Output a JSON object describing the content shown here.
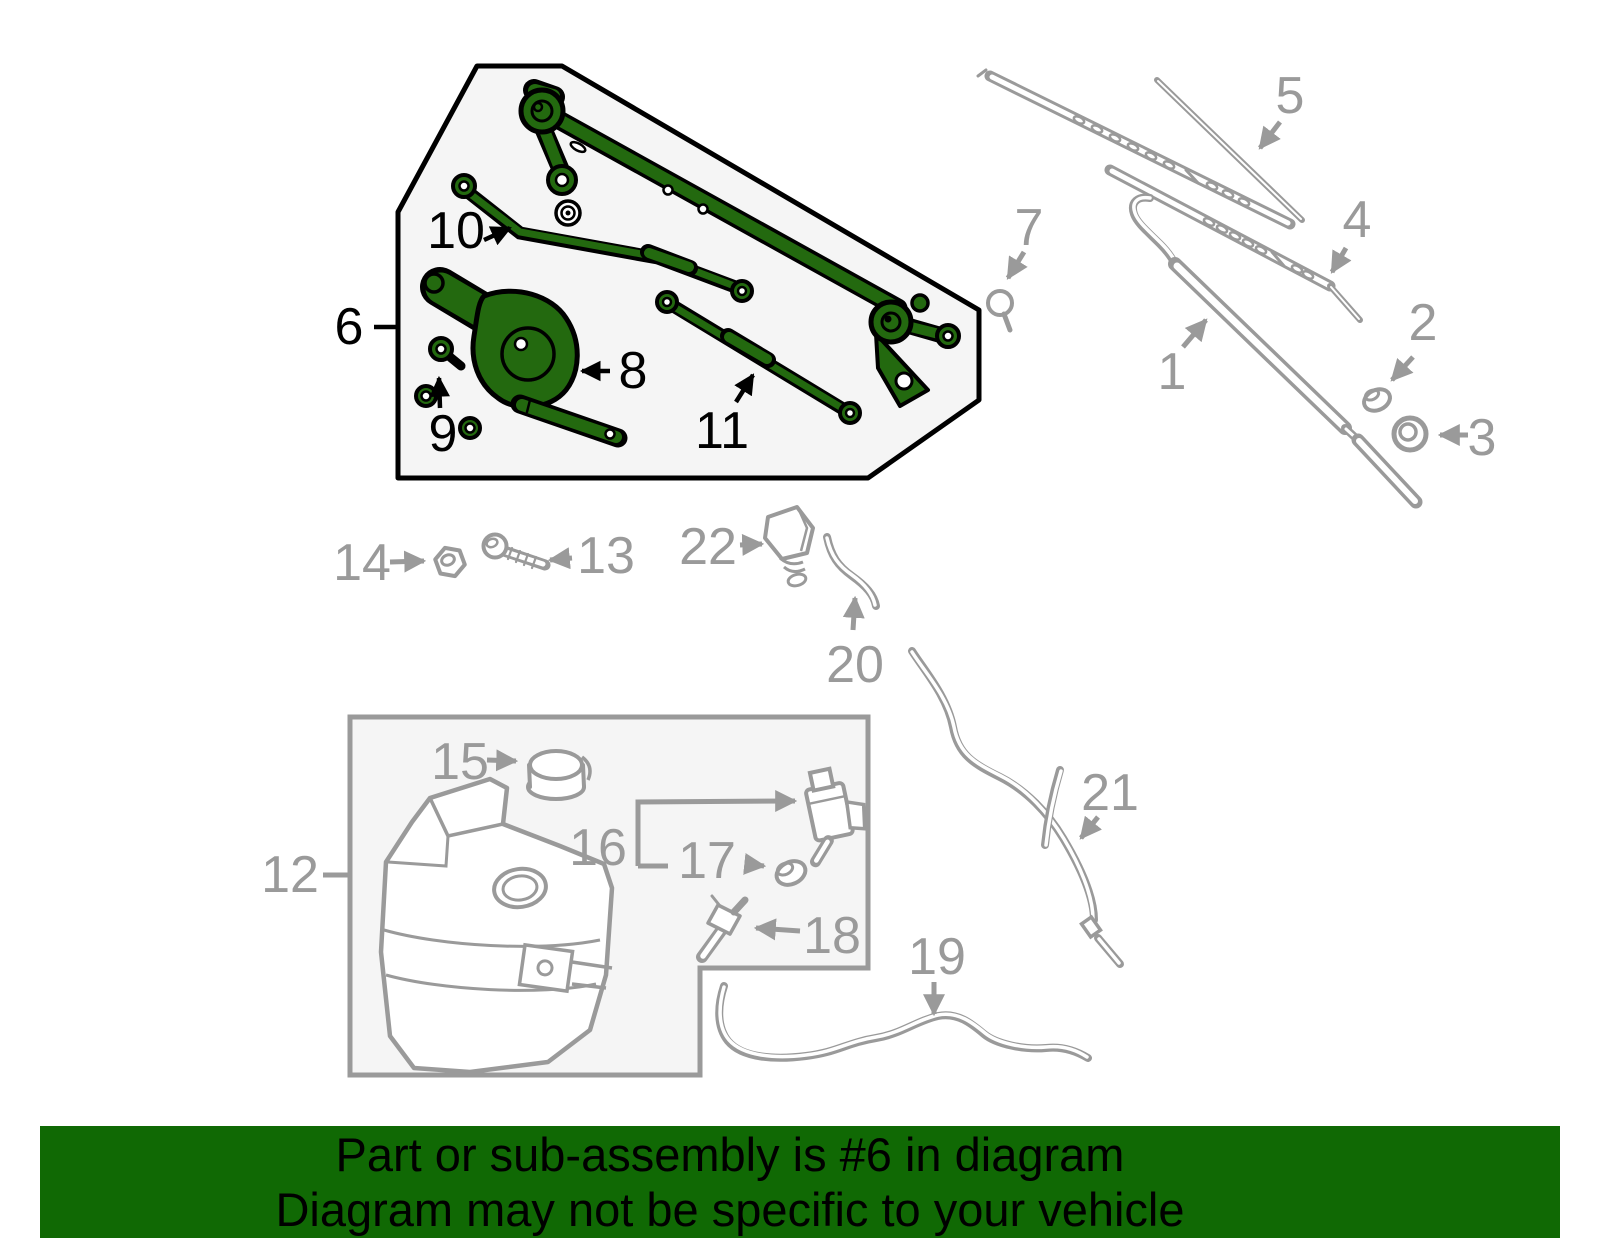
{
  "banner": {
    "line1": "Part or sub-assembly is #6 in diagram",
    "line2": "Diagram may not be specific to your vehicle",
    "bg_color": "#106904",
    "text_color": "#000000"
  },
  "diagram": {
    "highlighted_part": "6",
    "colors": {
      "highlight_green": "#23690F",
      "line_gray": "#9A9A9A",
      "outline_black": "#000000",
      "panel_fill": "#F5F5F5"
    },
    "callouts": [
      {
        "part": "1",
        "x": 1172,
        "y": 372,
        "style": "gray"
      },
      {
        "part": "2",
        "x": 1423,
        "y": 323,
        "style": "gray"
      },
      {
        "part": "3",
        "x": 1482,
        "y": 438,
        "style": "gray"
      },
      {
        "part": "4",
        "x": 1357,
        "y": 220,
        "style": "gray"
      },
      {
        "part": "5",
        "x": 1290,
        "y": 96,
        "style": "gray"
      },
      {
        "part": "6",
        "x": 349,
        "y": 327,
        "style": "black"
      },
      {
        "part": "7",
        "x": 1029,
        "y": 228,
        "style": "gray"
      },
      {
        "part": "8",
        "x": 633,
        "y": 371,
        "style": "black"
      },
      {
        "part": "9",
        "x": 443,
        "y": 434,
        "style": "black"
      },
      {
        "part": "10",
        "x": 456,
        "y": 231,
        "style": "black"
      },
      {
        "part": "11",
        "x": 722,
        "y": 431,
        "style": "black"
      },
      {
        "part": "12",
        "x": 290,
        "y": 875,
        "style": "gray"
      },
      {
        "part": "13",
        "x": 606,
        "y": 556,
        "style": "gray"
      },
      {
        "part": "14",
        "x": 362,
        "y": 563,
        "style": "gray"
      },
      {
        "part": "15",
        "x": 460,
        "y": 762,
        "style": "gray"
      },
      {
        "part": "16",
        "x": 598,
        "y": 848,
        "style": "gray"
      },
      {
        "part": "17",
        "x": 707,
        "y": 861,
        "style": "gray"
      },
      {
        "part": "18",
        "x": 832,
        "y": 936,
        "style": "gray"
      },
      {
        "part": "19",
        "x": 937,
        "y": 957,
        "style": "gray"
      },
      {
        "part": "20",
        "x": 855,
        "y": 665,
        "style": "gray"
      },
      {
        "part": "21",
        "x": 1110,
        "y": 793,
        "style": "gray"
      },
      {
        "part": "22",
        "x": 708,
        "y": 547,
        "style": "gray"
      }
    ]
  }
}
